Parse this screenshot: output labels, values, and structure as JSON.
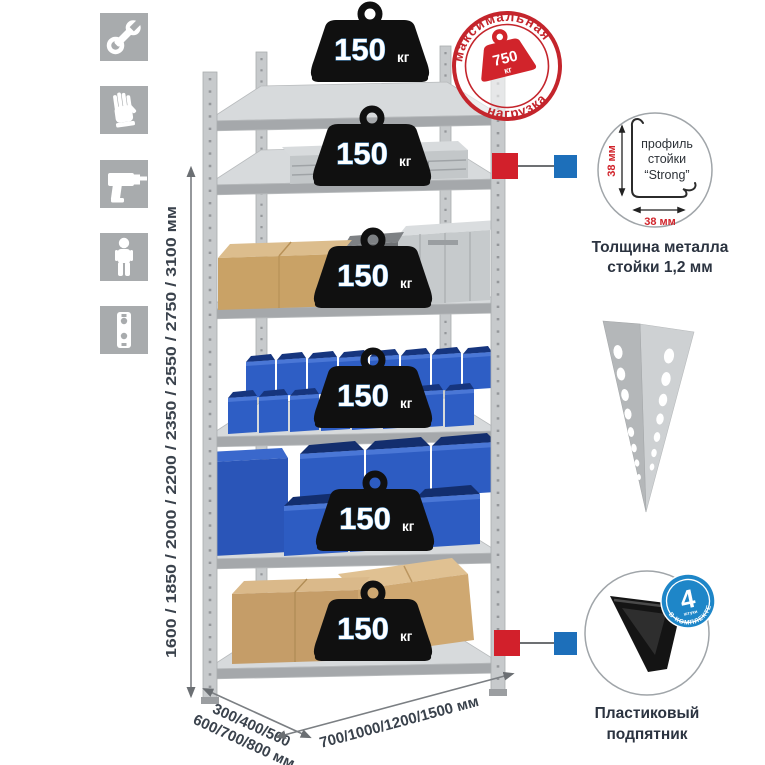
{
  "icons": [
    "wrench-icon",
    "gloves-icon",
    "drill-icon",
    "person-icon",
    "perforated-post-icon"
  ],
  "dimensions": {
    "height": "1600 / 1850 / 2000 / 2200 / 2350 / 2550 / 2750 / 3100 мм",
    "depth_line1": "300/400/500",
    "depth_line2": "600/700/800 мм",
    "width": "700/1000/1200/1500 мм"
  },
  "max_load_stamp": {
    "arc_top": "максимальная",
    "arc_bottom": "нагрузка",
    "value": "750",
    "unit": "кг"
  },
  "shelves": [
    {
      "load": "150",
      "unit": "кг"
    },
    {
      "load": "150",
      "unit": "кг"
    },
    {
      "load": "150",
      "unit": "кг"
    },
    {
      "load": "150",
      "unit": "кг"
    },
    {
      "load": "150",
      "unit": "кг"
    },
    {
      "load": "150",
      "unit": "кг"
    }
  ],
  "profile_detail": {
    "label_line1": "профиль",
    "label_line2": "стойки",
    "label_line3": "“Strong”",
    "dim_side": "38 мм",
    "dim_bottom": "38 мм",
    "caption_line1": "Толщина металла",
    "caption_line2": "стойки 1,2 мм"
  },
  "foot_detail": {
    "badge_count": "4",
    "badge_small": "штуки",
    "badge_arc": "В КОМПЛЕКТЕ",
    "caption_line1": "Пластиковый",
    "caption_line2": "подпятник"
  },
  "colors": {
    "stamp_red": "#c4252c",
    "marker_red": "#d2202b",
    "marker_blue": "#1d6fba",
    "badge_blue": "#1e86c8",
    "bin_blue": "#2e5ec5",
    "icon_gray": "#a8abad",
    "text_dark": "#3a424c"
  }
}
